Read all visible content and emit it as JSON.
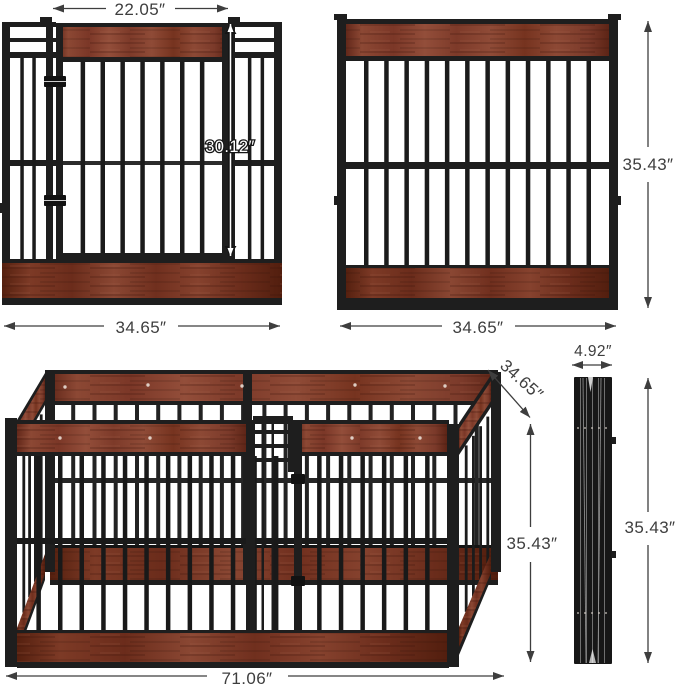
{
  "views": {
    "gate_panel": {
      "door_width": "22.05″",
      "door_height": "30.12″",
      "width": "34.65″"
    },
    "plain_panel": {
      "height": "35.43″",
      "width": "34.65″"
    },
    "assembled_pen": {
      "width": "71.06″",
      "depth": "34.65″",
      "height": "35.43″"
    },
    "folded_stack": {
      "thickness": "4.92″",
      "height": "35.43″"
    }
  },
  "colors": {
    "metal": "#1d1d1d",
    "wood": "#8a4433",
    "wood_dark": "#6b2c1b",
    "dimension": "#3e3e3e",
    "background": "#ffffff"
  }
}
